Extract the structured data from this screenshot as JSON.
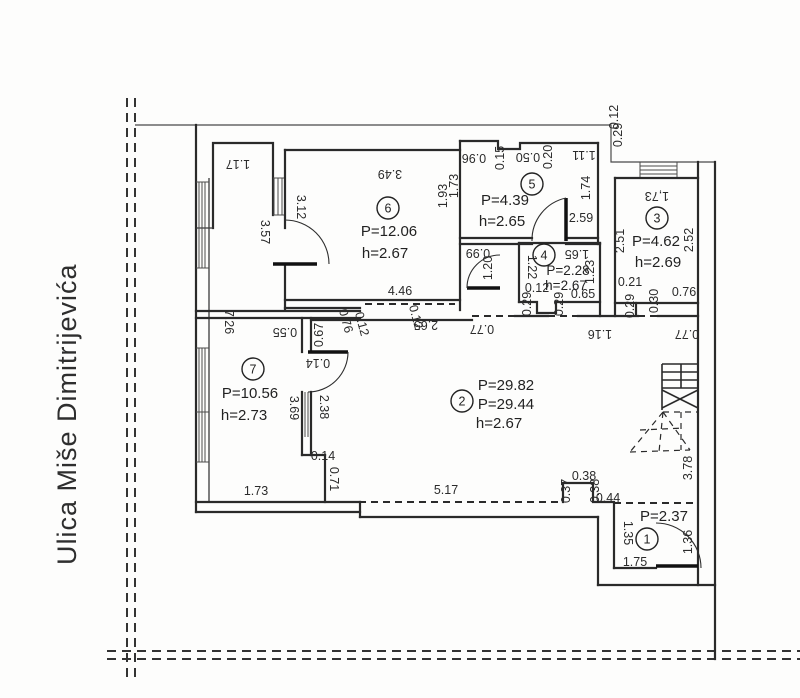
{
  "street": {
    "name": "Ulica Miše Dimitrijevića"
  },
  "colors": {
    "line": "#2a2a2a",
    "background": "#fdfdfc",
    "text": "#2b2b2b"
  },
  "rooms": [
    {
      "number": "6",
      "circle": {
        "x": 388,
        "y": 208
      },
      "fs": "normal",
      "labels": [
        {
          "t": "P=12.06",
          "x": 389,
          "y": 236
        },
        {
          "t": "h=2.67",
          "x": 385,
          "y": 258
        }
      ]
    },
    {
      "number": "5",
      "circle": {
        "x": 532,
        "y": 184
      },
      "fs": "normal",
      "labels": [
        {
          "t": "P=4.39",
          "x": 505,
          "y": 205
        },
        {
          "t": "h=2.65",
          "x": 502,
          "y": 226
        }
      ]
    },
    {
      "number": "4",
      "circle": {
        "x": 544,
        "y": 255
      },
      "fs": "small",
      "labels": [
        {
          "t": "P=2.28",
          "x": 568,
          "y": 275
        },
        {
          "t": "h=2.67",
          "x": 566,
          "y": 290
        }
      ]
    },
    {
      "number": "3",
      "circle": {
        "x": 657,
        "y": 218
      },
      "fs": "normal",
      "labels": [
        {
          "t": "P=4.62",
          "x": 656,
          "y": 246
        },
        {
          "t": "h=2.69",
          "x": 658,
          "y": 267
        }
      ]
    },
    {
      "number": "2",
      "circle": {
        "x": 462,
        "y": 401
      },
      "fs": "normal",
      "labels": [
        {
          "t": "P=29.82",
          "x": 506,
          "y": 390
        },
        {
          "t": "P=29.44",
          "x": 506,
          "y": 409
        },
        {
          "t": "h=2.67",
          "x": 499,
          "y": 428
        }
      ]
    },
    {
      "number": "7",
      "circle": {
        "x": 253,
        "y": 369
      },
      "fs": "normal",
      "labels": [
        {
          "t": "P=10.56",
          "x": 250,
          "y": 398
        },
        {
          "t": "h=2.73",
          "x": 244,
          "y": 420
        }
      ]
    },
    {
      "number": "1",
      "circle": {
        "x": 647,
        "y": 539
      },
      "fs": "normal",
      "labels": [
        {
          "t": "P=2.37",
          "x": 664,
          "y": 521
        }
      ]
    }
  ],
  "dimensions": [
    {
      "t": "1.17",
      "x": 238,
      "y": 160,
      "r": 180
    },
    {
      "t": "3.49",
      "x": 390,
      "y": 170,
      "r": 180
    },
    {
      "t": "3.12",
      "x": 297,
      "y": 207,
      "r": 90
    },
    {
      "t": "3.57",
      "x": 261,
      "y": 232,
      "r": 90
    },
    {
      "t": "1.93",
      "x": 447,
      "y": 196,
      "r": -90
    },
    {
      "t": "0.96",
      "x": 474,
      "y": 154,
      "r": 180
    },
    {
      "t": "0.15",
      "x": 504,
      "y": 158,
      "r": -90
    },
    {
      "t": "0.50",
      "x": 528,
      "y": 153,
      "r": 180
    },
    {
      "t": "0.20",
      "x": 552,
      "y": 157,
      "r": -90
    },
    {
      "t": "1.11",
      "x": 584,
      "y": 151,
      "r": 180
    },
    {
      "t": "1.73",
      "x": 458,
      "y": 186,
      "r": -90
    },
    {
      "t": "1.74",
      "x": 590,
      "y": 188,
      "r": -90
    },
    {
      "t": "2.59",
      "x": 581,
      "y": 222,
      "r": 0
    },
    {
      "t": "0.99",
      "x": 478,
      "y": 249,
      "r": 180
    },
    {
      "t": "1.20",
      "x": 492,
      "y": 268,
      "r": -90
    },
    {
      "t": "1.65",
      "x": 577,
      "y": 250,
      "r": 180
    },
    {
      "t": "1.22",
      "x": 528,
      "y": 267,
      "r": 90
    },
    {
      "t": "1.23",
      "x": 594,
      "y": 272,
      "r": -90
    },
    {
      "t": "0.12",
      "x": 537,
      "y": 292,
      "r": 0
    },
    {
      "t": "0.29",
      "x": 531,
      "y": 304,
      "r": -90
    },
    {
      "t": "0.29",
      "x": 563,
      "y": 304,
      "r": -90
    },
    {
      "t": "0.65",
      "x": 583,
      "y": 298,
      "r": 0
    },
    {
      "t": "1,73",
      "x": 657,
      "y": 192,
      "r": 180
    },
    {
      "t": "2.51",
      "x": 624,
      "y": 241,
      "r": -90
    },
    {
      "t": "2.52",
      "x": 693,
      "y": 240,
      "r": -90
    },
    {
      "t": "0.21",
      "x": 630,
      "y": 286,
      "r": 0
    },
    {
      "t": "0.29",
      "x": 634,
      "y": 306,
      "r": -90
    },
    {
      "t": "0.30",
      "x": 658,
      "y": 301,
      "r": -90
    },
    {
      "t": "0.76",
      "x": 684,
      "y": 296,
      "r": 0
    },
    {
      "t": "0.12",
      "x": 618,
      "y": 117,
      "r": -90
    },
    {
      "t": "0.29",
      "x": 622,
      "y": 135,
      "r": -90
    },
    {
      "t": "4.46",
      "x": 400,
      "y": 295,
      "r": 0
    },
    {
      "t": "2.65",
      "x": 426,
      "y": 321,
      "r": 180
    },
    {
      "t": "0.76",
      "x": 342,
      "y": 322,
      "r": 75
    },
    {
      "t": "0.12",
      "x": 358,
      "y": 325,
      "r": 75
    },
    {
      "t": "0.67",
      "x": 323,
      "y": 335,
      "r": -90
    },
    {
      "t": "0.55",
      "x": 285,
      "y": 328,
      "r": 180
    },
    {
      "t": "0.12",
      "x": 412,
      "y": 318,
      "r": 75
    },
    {
      "t": "0.77",
      "x": 482,
      "y": 325,
      "r": 180
    },
    {
      "t": "1.16",
      "x": 600,
      "y": 330,
      "r": 180
    },
    {
      "t": "0.77",
      "x": 687,
      "y": 330,
      "r": 180
    },
    {
      "t": "0.14",
      "x": 318,
      "y": 359,
      "r": 180
    },
    {
      "t": "7.26",
      "x": 225,
      "y": 322,
      "r": 90
    },
    {
      "t": "3.69",
      "x": 290,
      "y": 408,
      "r": 90
    },
    {
      "t": "2.38",
      "x": 320,
      "y": 407,
      "r": 90
    },
    {
      "t": "0.14",
      "x": 323,
      "y": 460,
      "r": 0
    },
    {
      "t": "0.71",
      "x": 330,
      "y": 479,
      "r": 90
    },
    {
      "t": "1.73",
      "x": 256,
      "y": 495,
      "r": 0
    },
    {
      "t": "5.17",
      "x": 446,
      "y": 494,
      "r": 0
    },
    {
      "t": "0.37",
      "x": 570,
      "y": 491,
      "r": -90
    },
    {
      "t": "0.38",
      "x": 584,
      "y": 480,
      "r": 0
    },
    {
      "t": "0.38",
      "x": 599,
      "y": 491,
      "r": -90
    },
    {
      "t": "0.44",
      "x": 608,
      "y": 502,
      "r": 0
    },
    {
      "t": "3.78",
      "x": 692,
      "y": 468,
      "r": -90
    },
    {
      "t": "1.35",
      "x": 624,
      "y": 533,
      "r": 90
    },
    {
      "t": "1.36",
      "x": 692,
      "y": 542,
      "r": -90
    },
    {
      "t": "1.75",
      "x": 635,
      "y": 566,
      "r": 0
    }
  ]
}
